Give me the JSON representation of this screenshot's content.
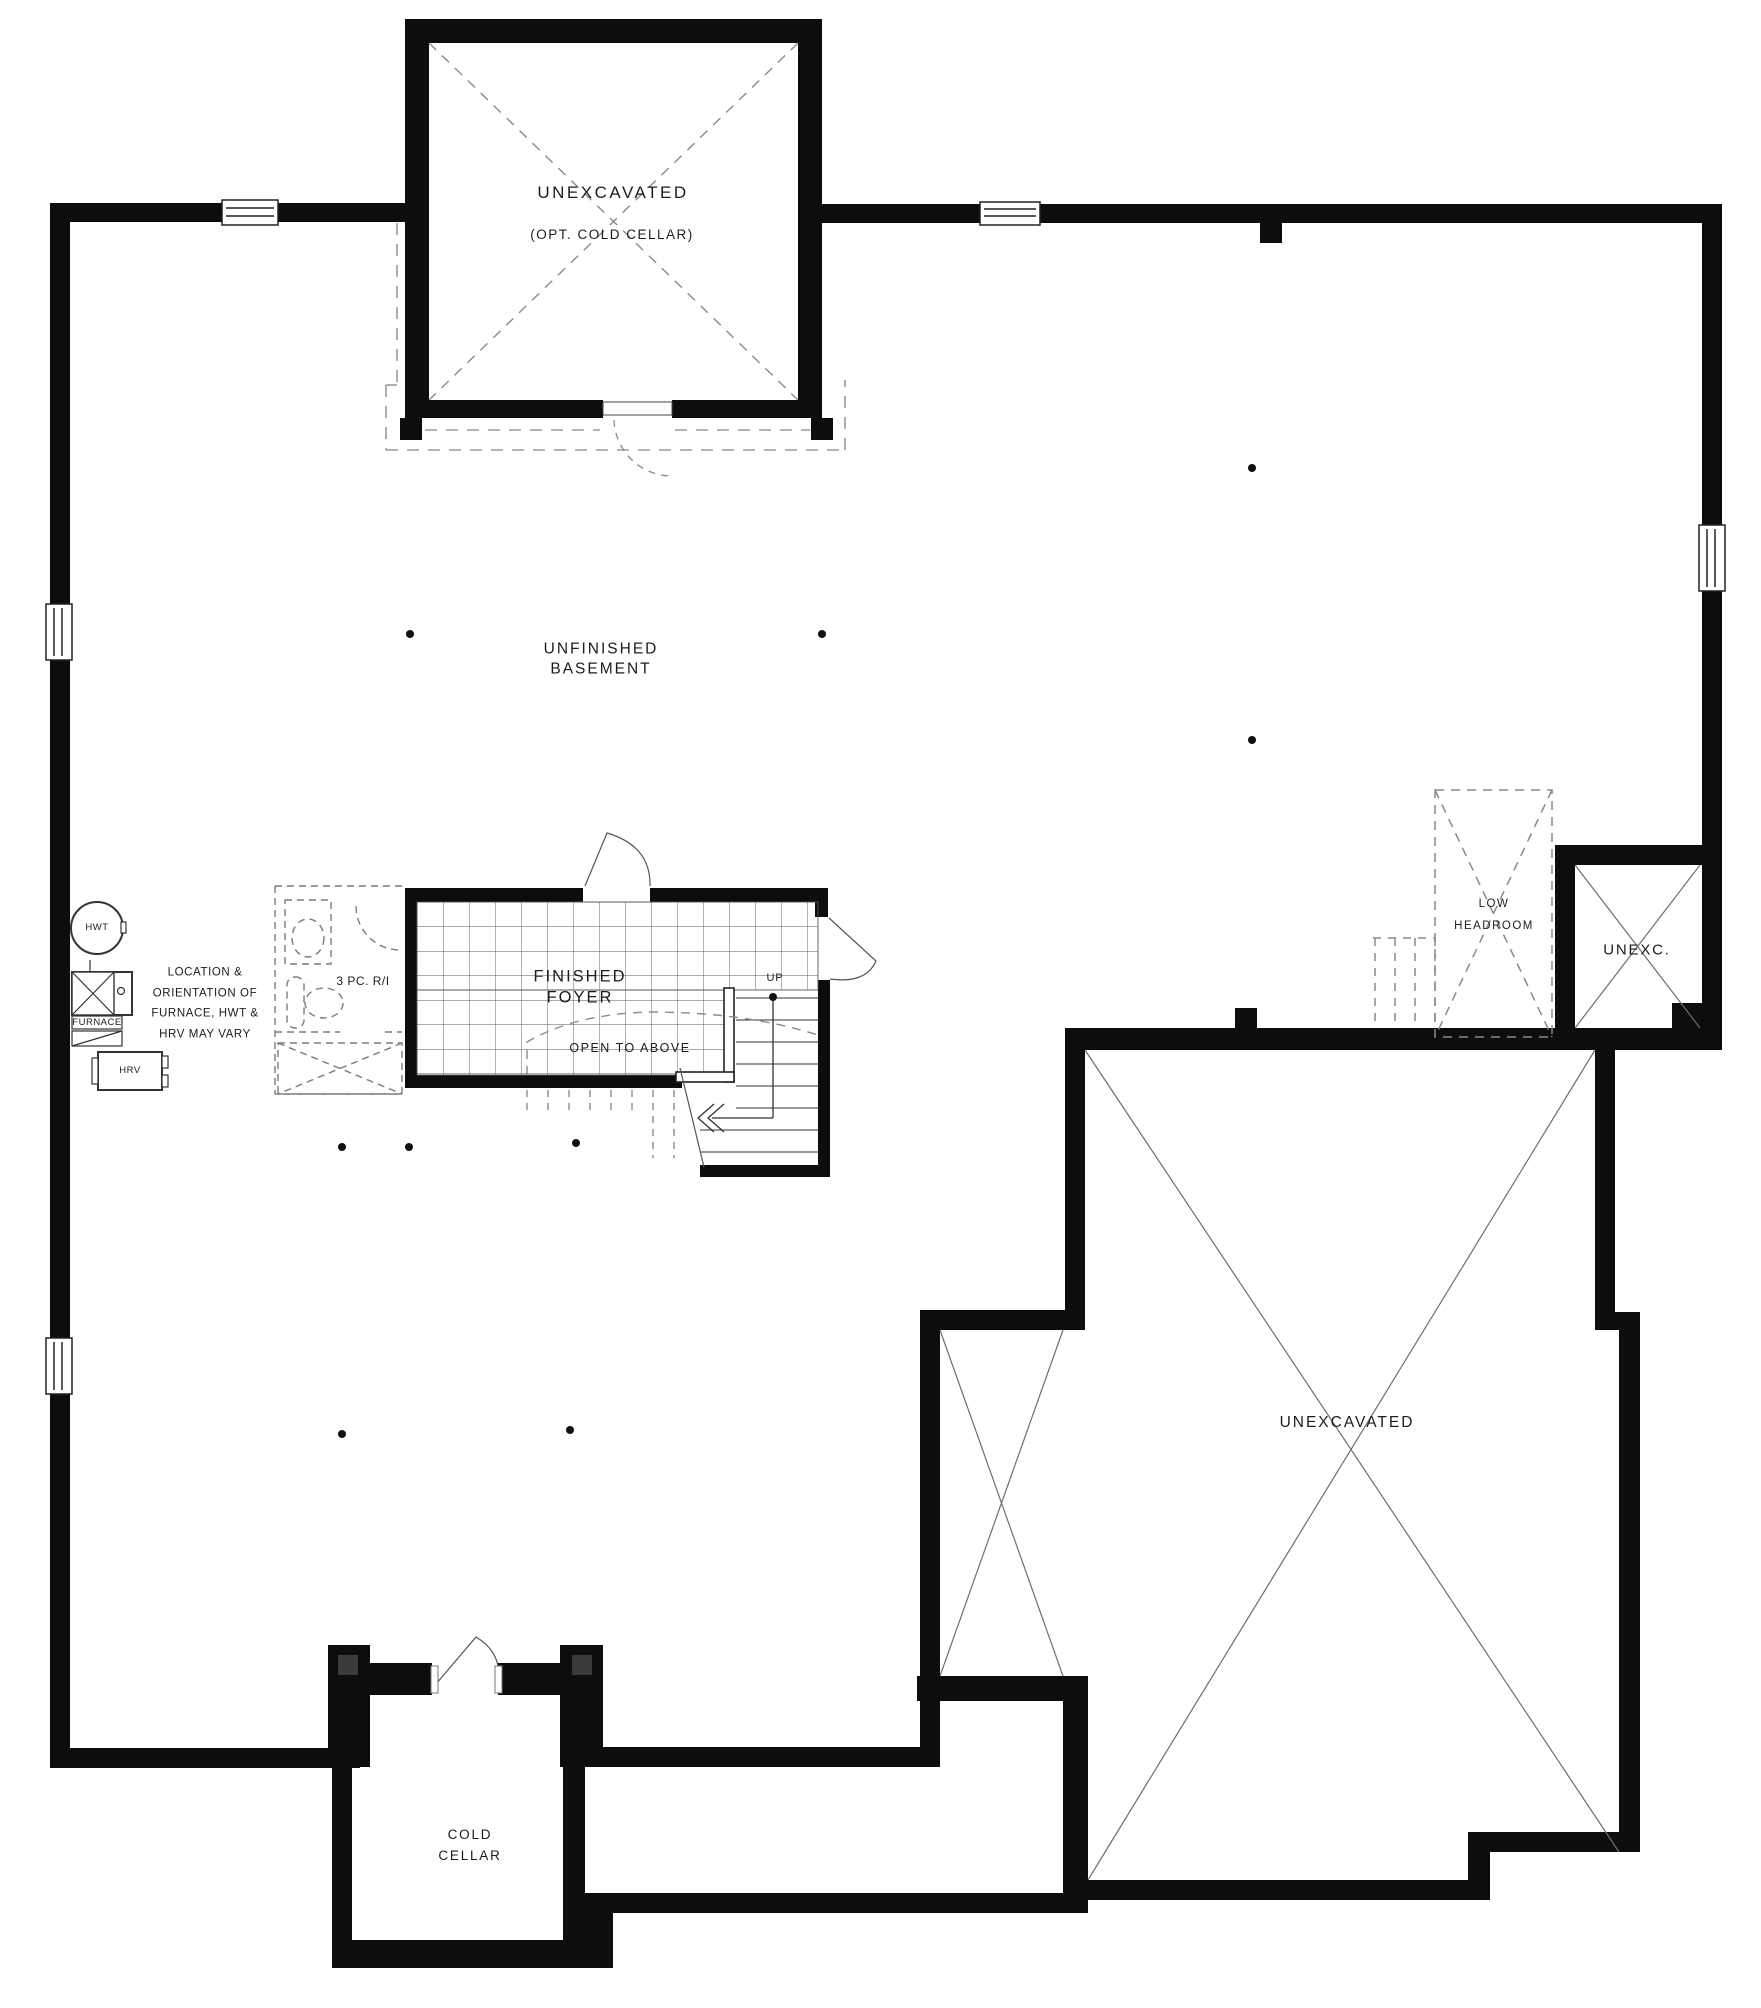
{
  "plan": {
    "rooms": {
      "unexcavated_top": {
        "name": "UNEXCAVATED",
        "sub": "(OPT. COLD CELLAR)"
      },
      "unfinished_basement": {
        "line1": "UNFINISHED",
        "line2": "BASEMENT"
      },
      "finished_foyer": {
        "line1": "FINISHED",
        "line2": "FOYER"
      },
      "cold_cellar": {
        "line1": "COLD",
        "line2": "CELLAR"
      },
      "unexcavated_main": {
        "name": "UNEXCAVATED"
      },
      "unexc_small": {
        "name": "UNEXC."
      },
      "low_headroom": {
        "line1": "LOW",
        "line2": "HEADROOM"
      }
    },
    "annotations": {
      "up": "UP",
      "open_to_above": "OPEN TO ABOVE",
      "bath_rough_in": "3 PC. R/I",
      "equipment_note": [
        "LOCATION &",
        "ORIENTATION OF",
        "FURNACE, HWT &",
        "HRV MAY VARY"
      ]
    },
    "equipment": {
      "hwt": "HWT",
      "furnace": "FURNACE",
      "hrv": "HRV"
    },
    "colors": {
      "wall": "#0d0d0d",
      "dashed": "#8a8a8a",
      "thin_line": "#6e6e6e",
      "text": "#1c1c1c",
      "background": "#ffffff"
    }
  }
}
